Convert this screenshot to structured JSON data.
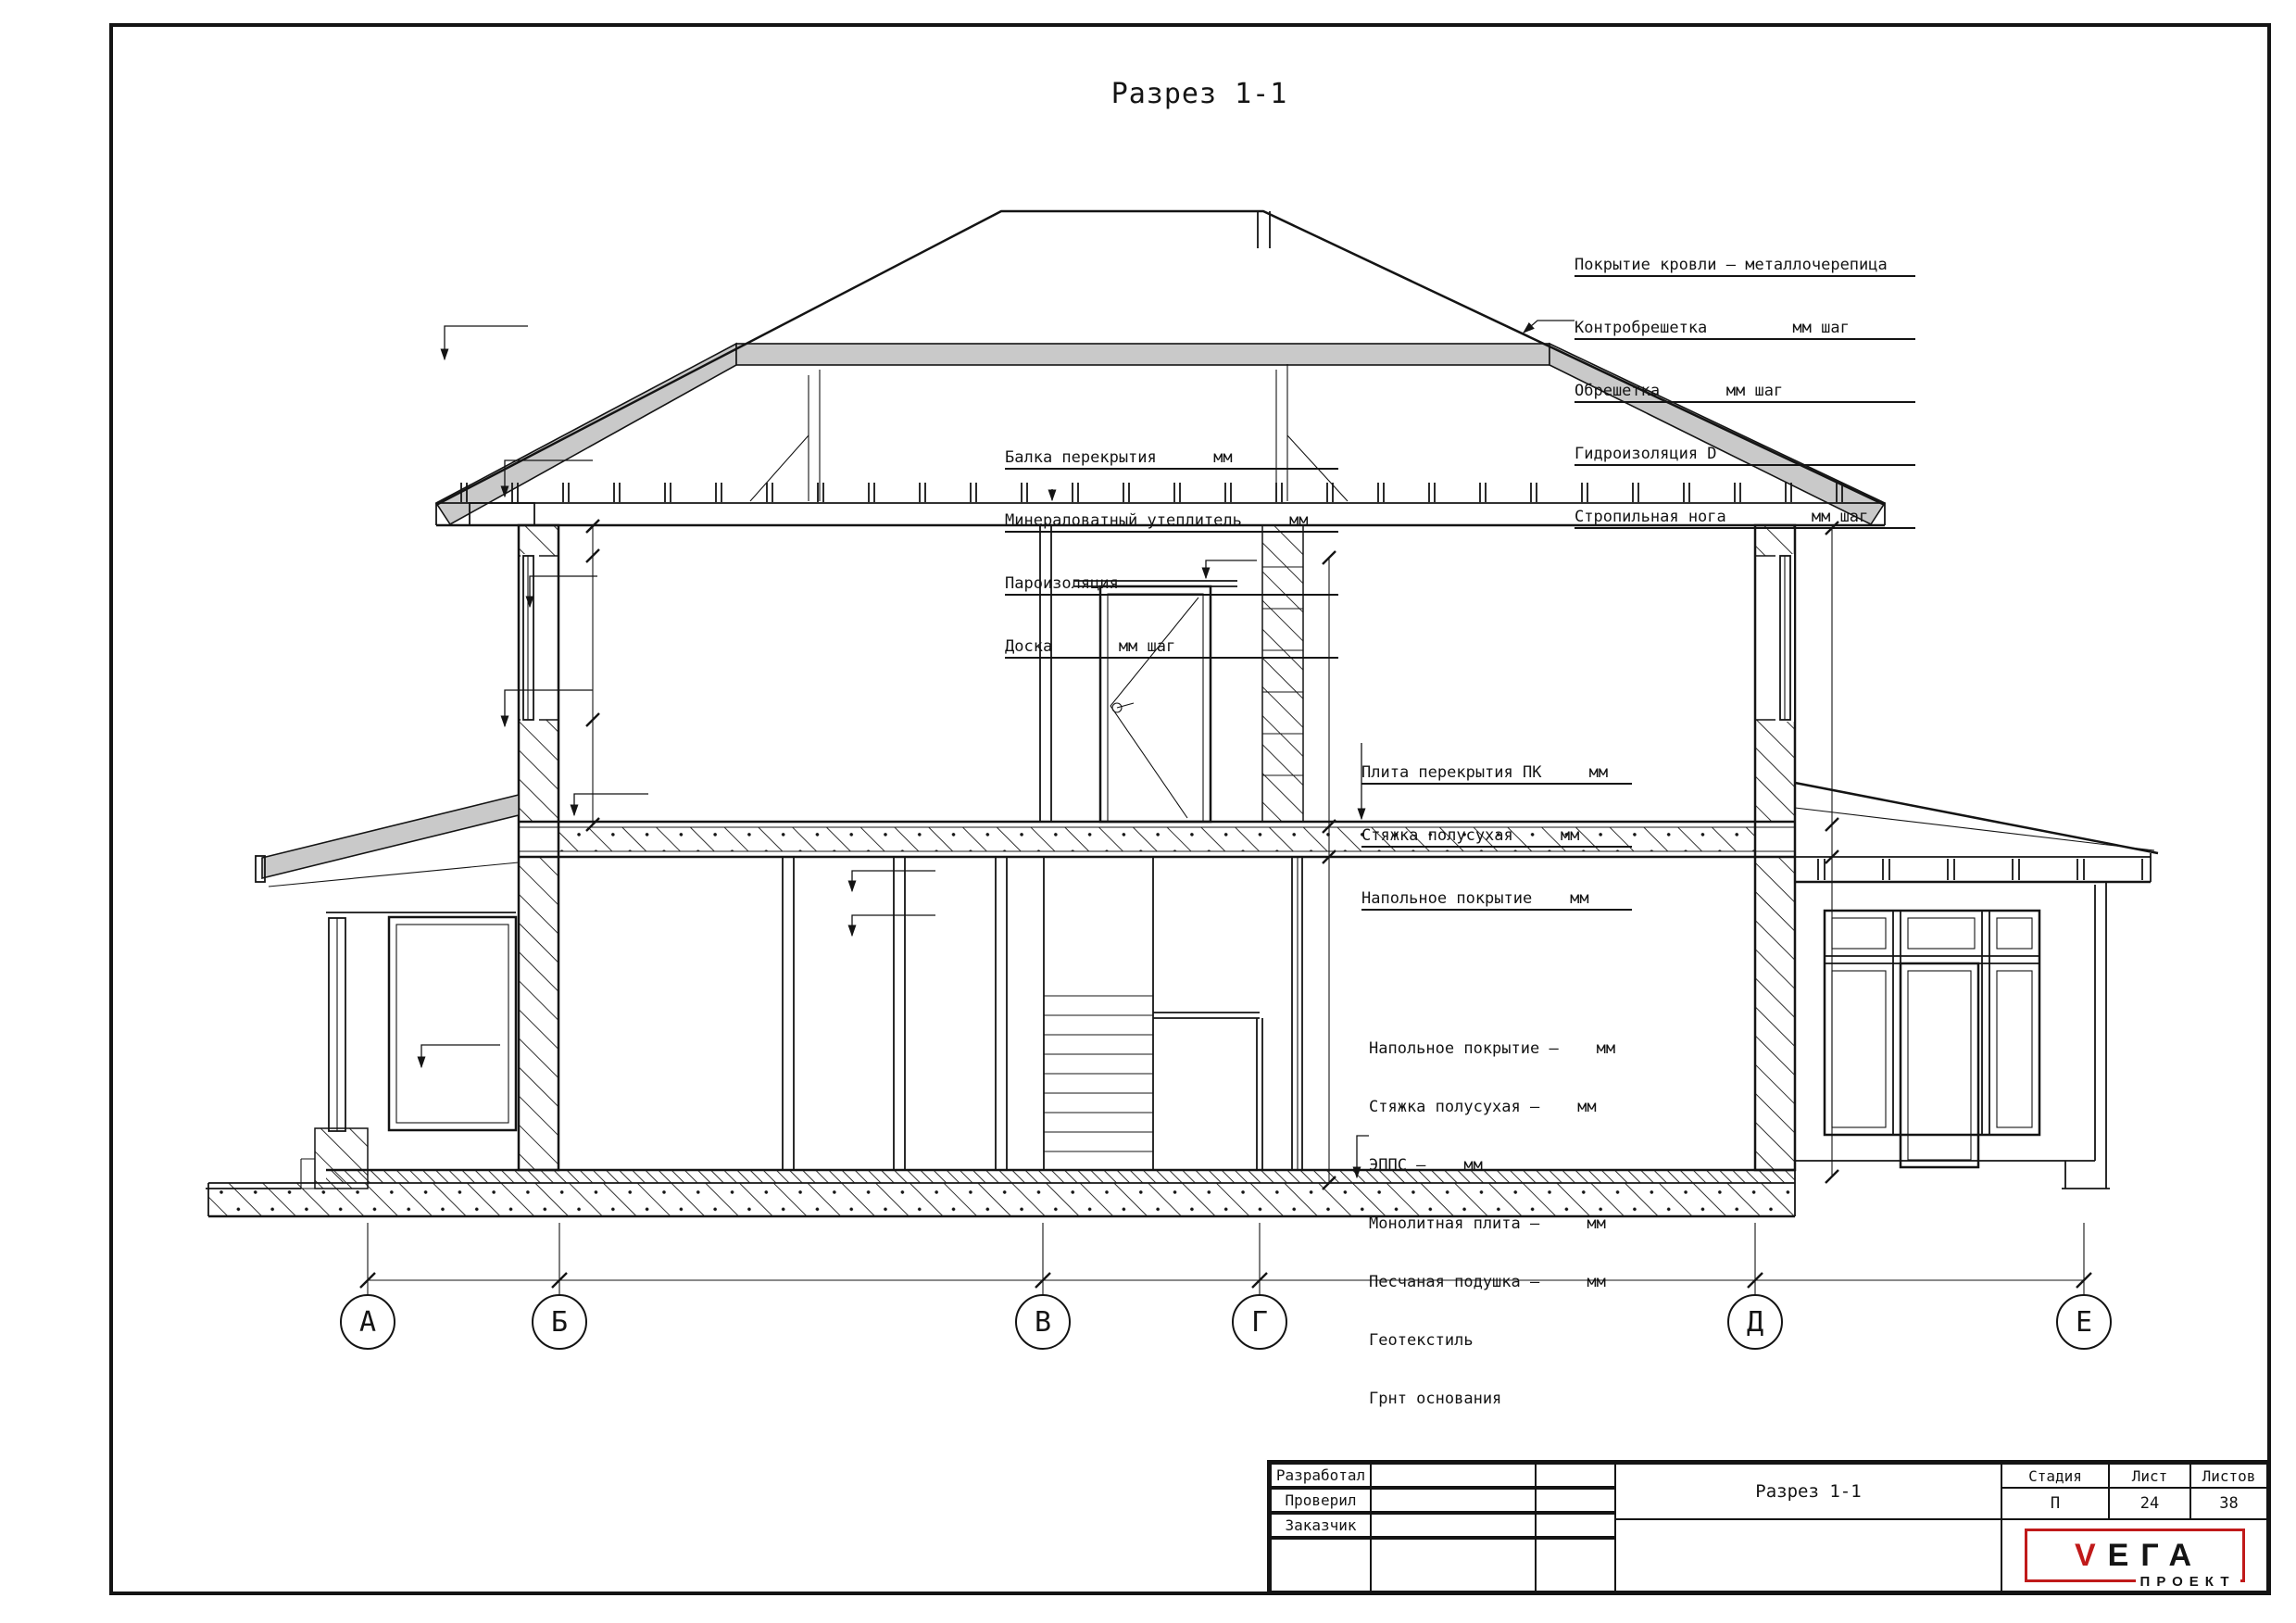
{
  "page": {
    "title": "Разрез 1-1"
  },
  "notes": {
    "roof": [
      "Покрытие кровли – металлочерепица",
      "Контробрешетка         мм шаг",
      "Обрешетка       мм шаг",
      "Гидроизоляция D",
      "Стропильная нога         мм шаг"
    ],
    "ceiling": [
      "Балка перекрытия      мм",
      "Минераловатный утеплитель     мм",
      "Пароизоляция",
      "Доска       мм шаг"
    ],
    "slab": [
      "Плита перекрытия ПК     мм",
      "Стяжка полусухая     мм",
      "Напольное покрытие    мм"
    ],
    "floor": [
      "Напольное покрытие –    мм",
      "Стяжка полусухая –    мм",
      "ЭППС –    мм",
      "Монолитная плита –     мм",
      "Песчаная подушка –     мм",
      "Геотекстиль",
      "Грнт основания"
    ]
  },
  "axes": {
    "labels": [
      "А",
      "Б",
      "В",
      "Г",
      "Д",
      "Е"
    ]
  },
  "titleblock": {
    "row1": "Разработал",
    "row2": "Проверил",
    "row3": "Заказчик",
    "drawing_title": "Разрез 1-1",
    "stage_label": "Стадия",
    "sheet_label": "Лист",
    "sheets_label": "Листов",
    "stage_value": "П",
    "sheet_value": "24",
    "sheets_value": "38",
    "logo": {
      "v": "V",
      "rest": "ЕГА",
      "sub": "ПРОЕКТ"
    }
  },
  "colors": {
    "accent_red": "#c01a1a",
    "roof_gray": "#c9c9c9",
    "line": "#141414",
    "hatch_gray": "#9a9a9a"
  }
}
